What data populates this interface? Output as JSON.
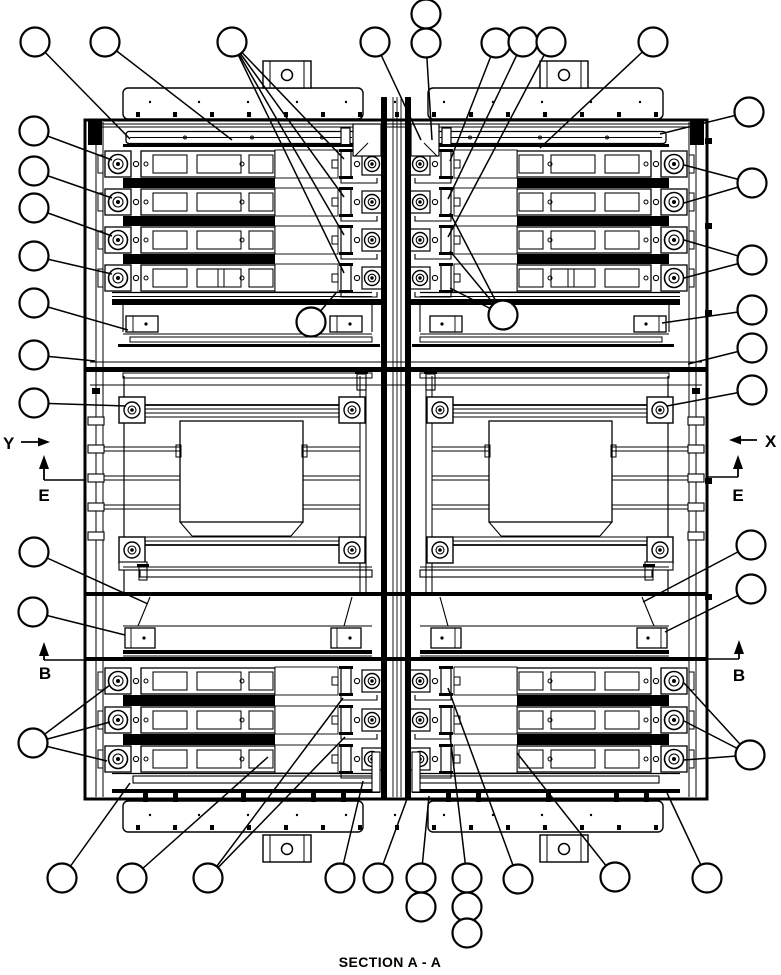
{
  "drawing": {
    "title": "SECTION A - A",
    "labels": {
      "y_direction": "Y",
      "x_direction": "X",
      "section_e_left": "E",
      "section_e_right": "E",
      "section_b_left": "B",
      "section_b_right": "B"
    },
    "callouts": [
      {
        "label": "",
        "cx": 35,
        "cy": 42,
        "leaders": [
          [
            130,
            139
          ]
        ]
      },
      {
        "label": "",
        "cx": 105,
        "cy": 42,
        "leaders": [
          [
            232,
            140
          ]
        ]
      },
      {
        "label": "",
        "cx": 232,
        "cy": 42,
        "leaders": [
          [
            344,
            159
          ],
          [
            344,
            197
          ],
          [
            344,
            235
          ],
          [
            344,
            273
          ]
        ]
      },
      {
        "label": "",
        "cx": 375,
        "cy": 42,
        "leaders": [
          [
            421,
            140
          ]
        ]
      },
      {
        "label": "",
        "cx": 426,
        "cy": 14,
        "leaders": []
      },
      {
        "label": "",
        "cx": 426,
        "cy": 43,
        "leaders": [
          [
            432,
            140
          ]
        ]
      },
      {
        "label": "",
        "cx": 496,
        "cy": 43,
        "leaders": [
          [
            450,
            161
          ]
        ]
      },
      {
        "label": "",
        "cx": 523,
        "cy": 42,
        "leaders": [
          [
            448,
            199
          ]
        ]
      },
      {
        "label": "",
        "cx": 551,
        "cy": 42,
        "leaders": [
          [
            448,
            237
          ]
        ]
      },
      {
        "label": "",
        "cx": 653,
        "cy": 42,
        "leaders": [
          [
            540,
            148
          ]
        ]
      },
      {
        "label": "",
        "cx": 749,
        "cy": 112,
        "leaders": [
          [
            660,
            134
          ]
        ]
      },
      {
        "label": "",
        "cx": 752,
        "cy": 183,
        "leaders": [
          [
            684,
            165
          ],
          [
            684,
            203
          ]
        ]
      },
      {
        "label": "",
        "cx": 752,
        "cy": 260,
        "leaders": [
          [
            684,
            240
          ],
          [
            684,
            278
          ]
        ]
      },
      {
        "label": "",
        "cx": 752,
        "cy": 310,
        "leaders": [
          [
            662,
            323
          ]
        ]
      },
      {
        "label": "",
        "cx": 752,
        "cy": 348,
        "leaders": [
          [
            688,
            364
          ]
        ]
      },
      {
        "label": "",
        "cx": 752,
        "cy": 390,
        "leaders": [
          [
            667,
            406
          ]
        ]
      },
      {
        "label": "",
        "cx": 751,
        "cy": 545,
        "leaders": [
          [
            643,
            602
          ]
        ]
      },
      {
        "label": "",
        "cx": 751,
        "cy": 589,
        "leaders": [
          [
            665,
            632
          ]
        ]
      },
      {
        "label": "",
        "cx": 750,
        "cy": 755,
        "leaders": [
          [
            684,
            683
          ],
          [
            684,
            721
          ],
          [
            684,
            760
          ]
        ]
      },
      {
        "label": "",
        "cx": 34,
        "cy": 131,
        "leaders": [
          [
            112,
            160
          ]
        ]
      },
      {
        "label": "",
        "cx": 34,
        "cy": 171,
        "leaders": [
          [
            112,
            198
          ]
        ]
      },
      {
        "label": "",
        "cx": 34,
        "cy": 208,
        "leaders": [
          [
            112,
            236
          ]
        ]
      },
      {
        "label": "",
        "cx": 34,
        "cy": 256,
        "leaders": [
          [
            112,
            274
          ]
        ]
      },
      {
        "label": "",
        "cx": 34,
        "cy": 303,
        "leaders": [
          [
            128,
            330
          ]
        ]
      },
      {
        "label": "",
        "cx": 34,
        "cy": 355,
        "leaders": [
          [
            95,
            361
          ]
        ]
      },
      {
        "label": "",
        "cx": 34,
        "cy": 403,
        "leaders": [
          [
            126,
            406
          ]
        ]
      },
      {
        "label": "",
        "cx": 34,
        "cy": 552,
        "leaders": [
          [
            148,
            604
          ]
        ]
      },
      {
        "label": "",
        "cx": 33,
        "cy": 612,
        "leaders": [
          [
            125,
            635
          ]
        ]
      },
      {
        "label": "",
        "cx": 33,
        "cy": 743,
        "leaders": [
          [
            110,
            685
          ],
          [
            110,
            722
          ],
          [
            107,
            761
          ]
        ]
      },
      {
        "label": "",
        "cx": 311,
        "cy": 322,
        "leaders": [
          [
            336,
            293
          ]
        ]
      },
      {
        "label": "",
        "cx": 503,
        "cy": 315,
        "leaders": [
          [
            450,
            213
          ],
          [
            450,
            251
          ],
          [
            450,
            288
          ]
        ]
      },
      {
        "label": "",
        "cx": 62,
        "cy": 878,
        "leaders": [
          [
            130,
            783
          ]
        ]
      },
      {
        "label": "",
        "cx": 132,
        "cy": 878,
        "leaders": [
          [
            268,
            757
          ]
        ]
      },
      {
        "label": "",
        "cx": 208,
        "cy": 878,
        "leaders": [
          [
            343,
            698
          ],
          [
            345,
            737
          ]
        ]
      },
      {
        "label": "",
        "cx": 340,
        "cy": 878,
        "leaders": [
          [
            363,
            781
          ]
        ]
      },
      {
        "label": "",
        "cx": 378,
        "cy": 878,
        "leaders": [
          [
            407,
            799
          ]
        ]
      },
      {
        "label": "",
        "cx": 421,
        "cy": 878,
        "leaders": [
          [
            429,
            796
          ]
        ]
      },
      {
        "label": "",
        "cx": 421,
        "cy": 907,
        "leaders": []
      },
      {
        "label": "",
        "cx": 467,
        "cy": 878,
        "leaders": [
          [
            450,
            735
          ]
        ]
      },
      {
        "label": "",
        "cx": 467,
        "cy": 907,
        "leaders": []
      },
      {
        "label": "",
        "cx": 467,
        "cy": 933,
        "leaders": []
      },
      {
        "label": "",
        "cx": 518,
        "cy": 879,
        "leaders": [
          [
            448,
            688
          ]
        ]
      },
      {
        "label": "",
        "cx": 615,
        "cy": 877,
        "leaders": [
          [
            517,
            753
          ]
        ]
      },
      {
        "label": "",
        "cx": 707,
        "cy": 878,
        "leaders": [
          [
            667,
            793
          ]
        ]
      }
    ]
  }
}
